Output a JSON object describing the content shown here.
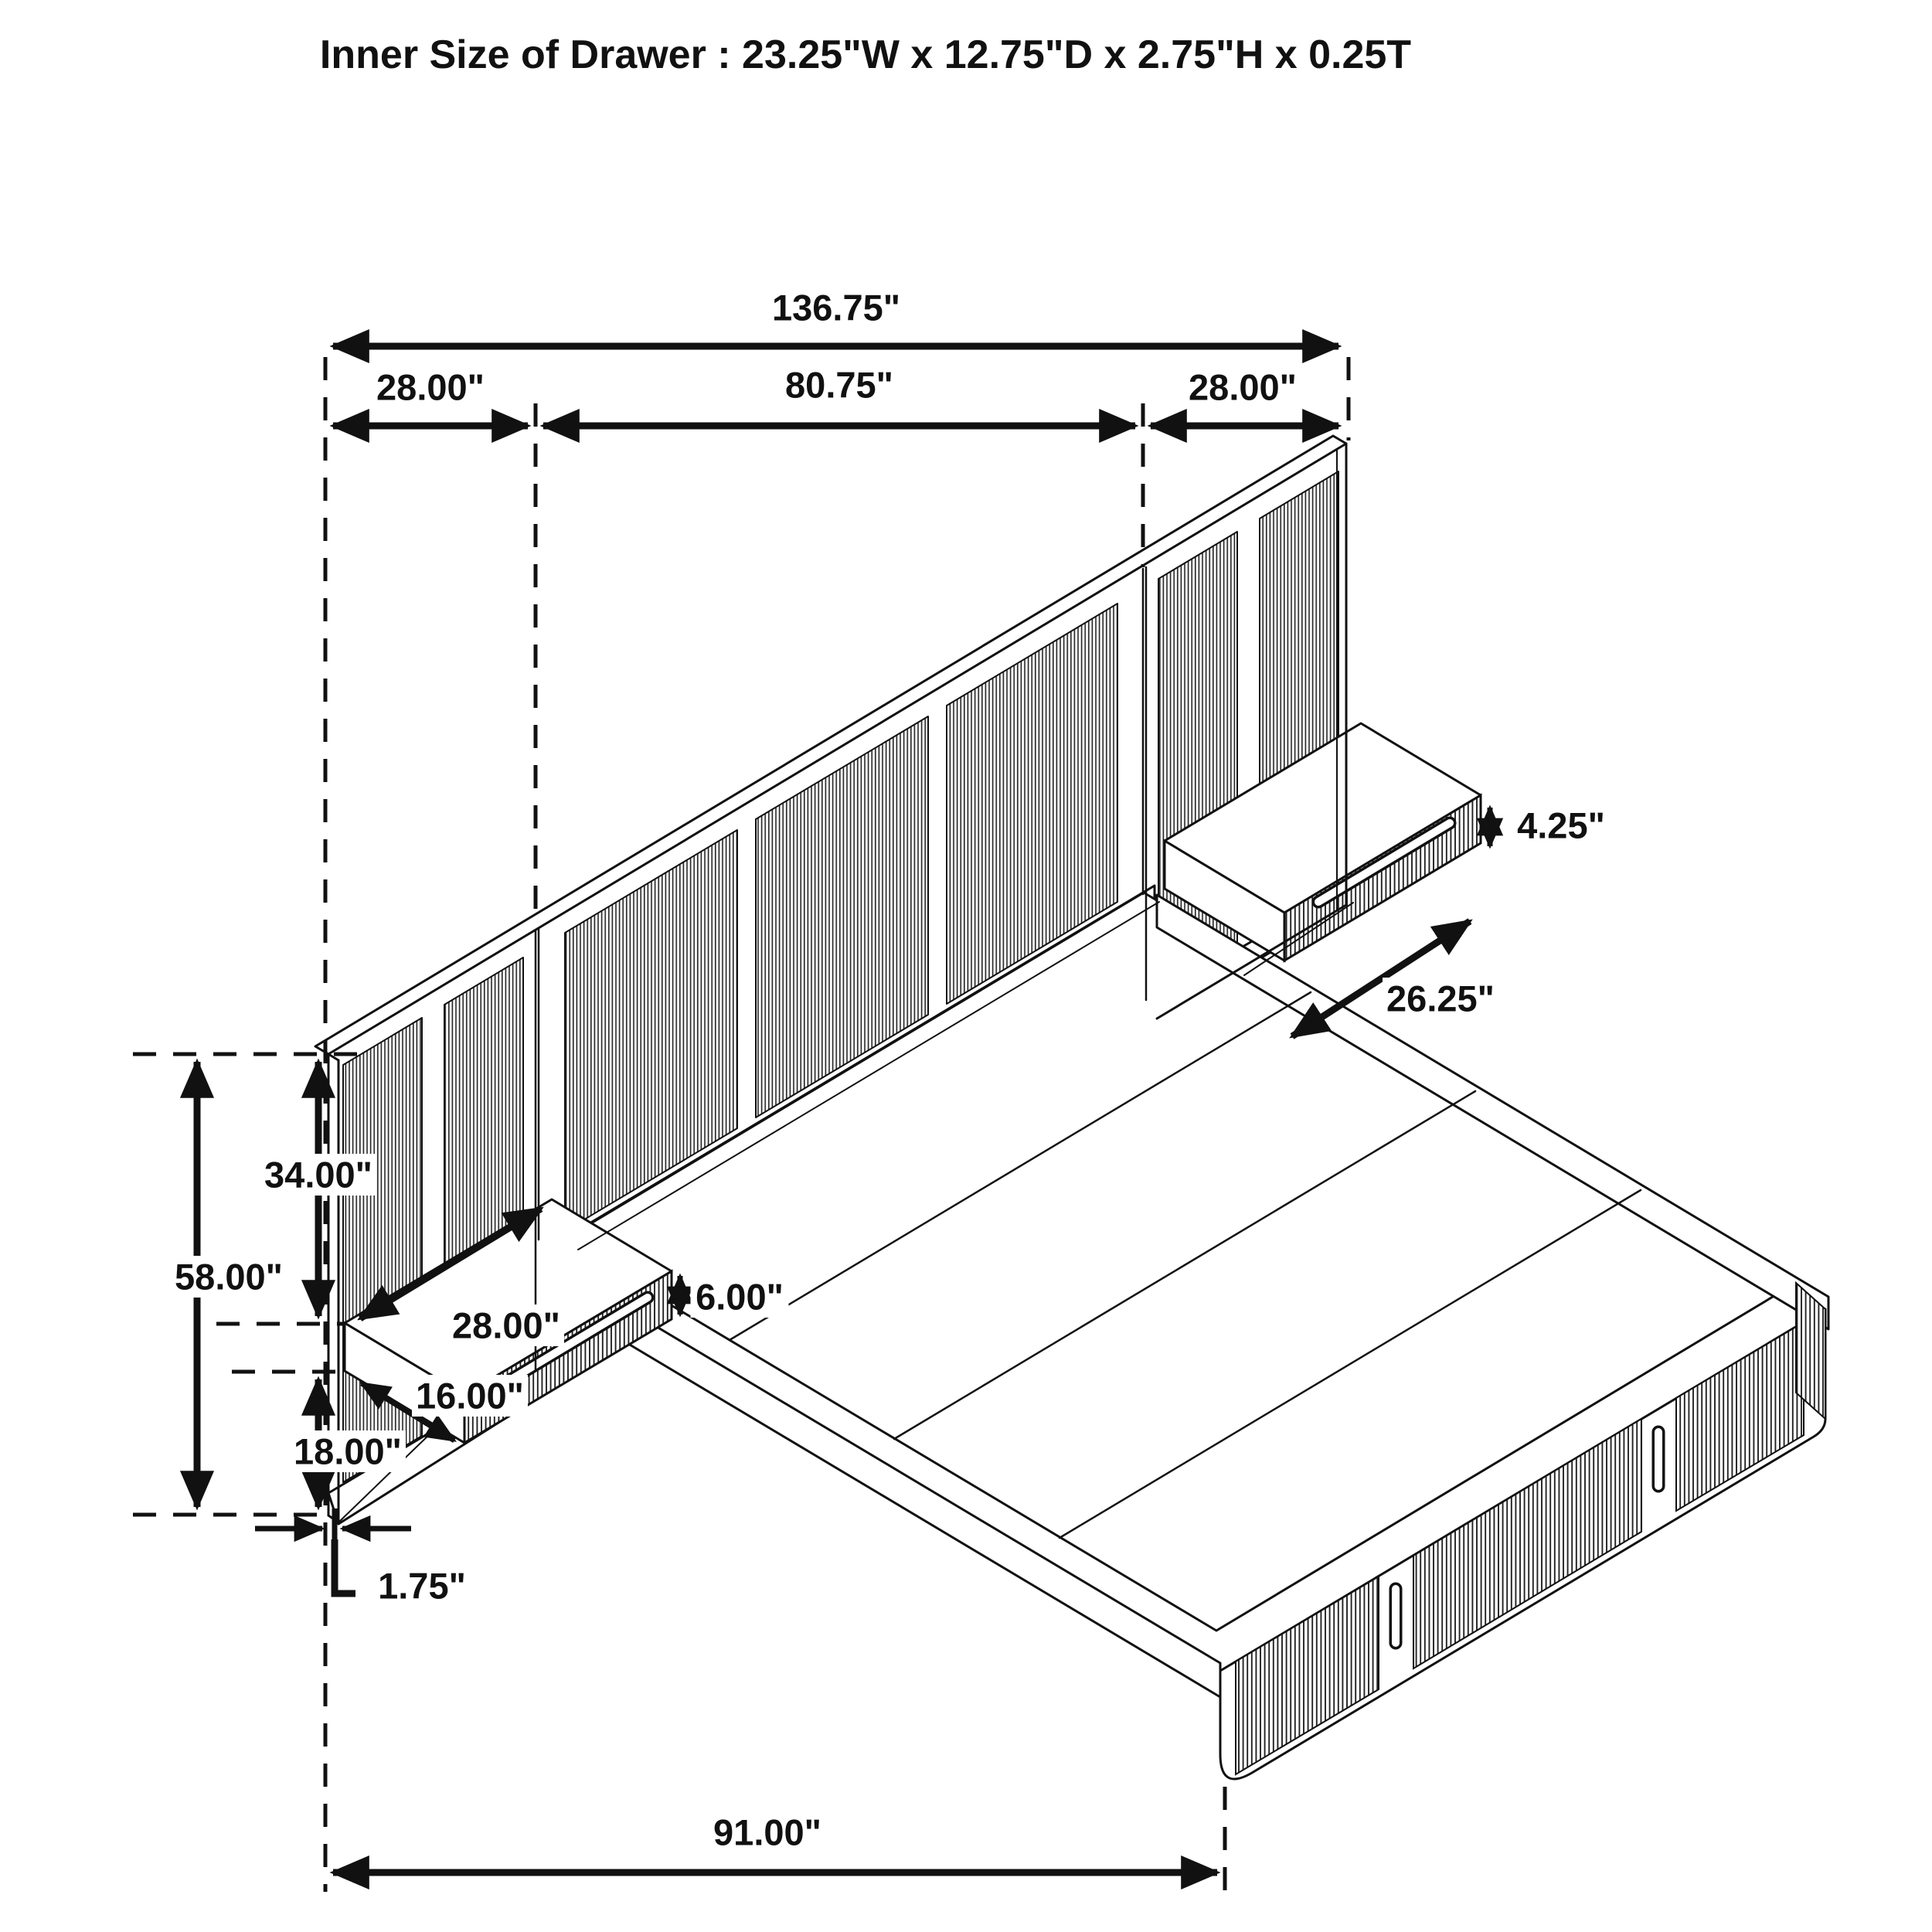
{
  "title": "Inner Size of Drawer : 23.25\"W x 12.75\"D x 2.75\"H x 0.25T",
  "figure": {
    "description": "Isometric line drawing of a wall-panel storage bed with two floating nightstand drawers",
    "line_color": "#111111",
    "background_color": "#ffffff"
  },
  "dimensions": {
    "overall_width": "136.75\"",
    "left_section": "28.00\"",
    "center_section": "80.75\"",
    "right_section": "28.00\"",
    "total_height": "58.00\"",
    "upper_height": "34.00\"",
    "lower_height": "18.00\"",
    "panel_thickness": "1.75\"",
    "platform_length": "91.00\"",
    "shelf_width": "28.00\"",
    "shelf_depth": "16.00\"",
    "shelf_height": "6.00\"",
    "right_shelf_drawer_height": "4.25\"",
    "right_shelf_length": "26.25\""
  }
}
